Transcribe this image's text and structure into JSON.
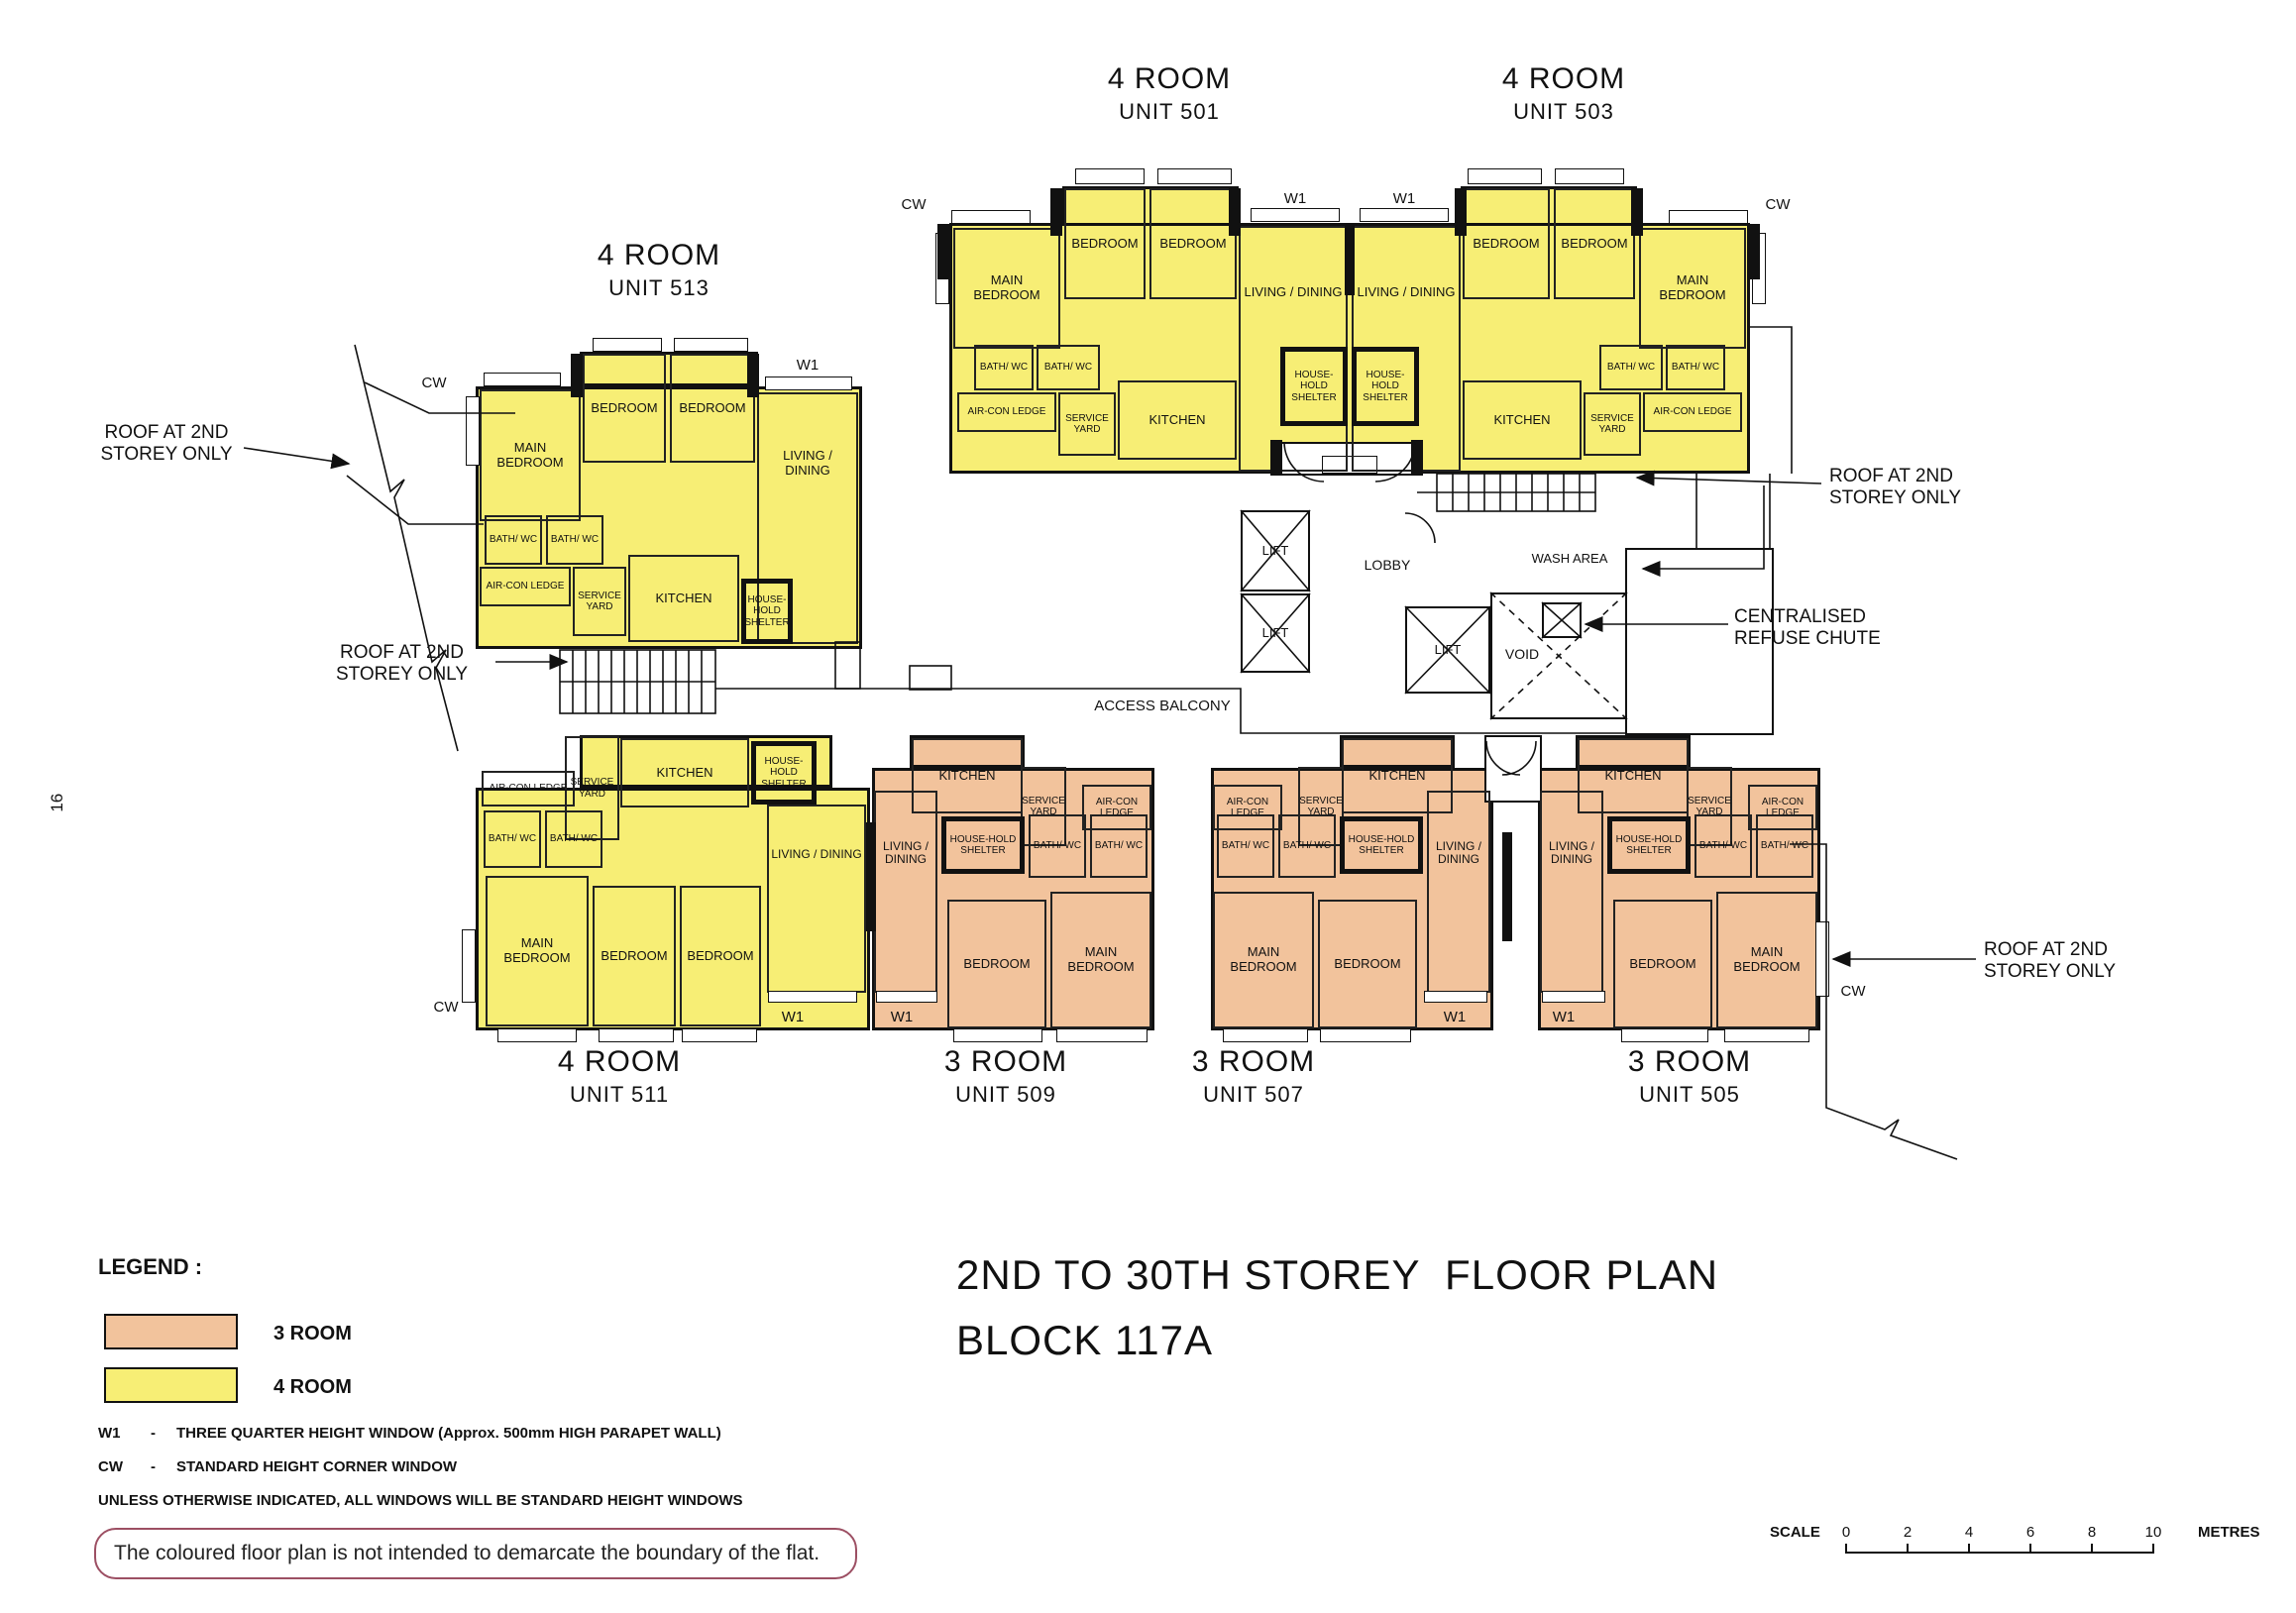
{
  "page_number": "16",
  "header": {
    "title_line1": "2ND TO 30TH STOREY  FLOOR PLAN",
    "title_line2": "BLOCK 117A"
  },
  "colors": {
    "three_room": "#f2c39c",
    "four_room": "#f7ee75"
  },
  "legend": {
    "heading": "LEGEND :",
    "items": [
      {
        "label": "3 ROOM",
        "color": "#f2c39c"
      },
      {
        "label": "4 ROOM",
        "color": "#f7ee75"
      }
    ],
    "window_notes": [
      {
        "code": "W1",
        "dash": "-",
        "text": "THREE QUARTER HEIGHT WINDOW (Approx. 500mm HIGH PARAPET WALL)"
      },
      {
        "code": "CW",
        "dash": "-",
        "text": "STANDARD HEIGHT CORNER WINDOW"
      }
    ],
    "footnote": "UNLESS OTHERWISE INDICATED, ALL WINDOWS WILL BE STANDARD HEIGHT WINDOWS"
  },
  "disclaimer": "The coloured floor plan is not intended to demarcate the boundary of the flat.",
  "scale_bar": {
    "label": "SCALE",
    "ticks": [
      "0",
      "2",
      "4",
      "6",
      "8",
      "10"
    ],
    "unit": "METRES"
  },
  "units": {
    "u501": {
      "type": "4 ROOM",
      "number": "UNIT 501"
    },
    "u503": {
      "type": "4 ROOM",
      "number": "UNIT 503"
    },
    "u513": {
      "type": "4 ROOM",
      "number": "UNIT 513"
    },
    "u511": {
      "type": "4 ROOM",
      "number": "UNIT 511"
    },
    "u509": {
      "type": "3 ROOM",
      "number": "UNIT 509"
    },
    "u507": {
      "type": "3 ROOM",
      "number": "UNIT 507"
    },
    "u505": {
      "type": "3 ROOM",
      "number": "UNIT 505"
    }
  },
  "room_labels": {
    "main_bedroom": "MAIN BEDROOM",
    "bedroom": "BEDROOM",
    "living_dining": "LIVING / DINING",
    "kitchen": "KITCHEN",
    "bath_wc": "BATH/ WC",
    "aircon_ledge": "AIR-CON LEDGE",
    "service_yard": "SERVICE YARD",
    "household_shelter": "HOUSE-HOLD SHELTER",
    "lift": "LIFT",
    "lobby": "LOBBY",
    "wash_area": "WASH AREA",
    "void": "VOID",
    "access_balcony": "ACCESS BALCONY"
  },
  "window_codes": {
    "w1": "W1",
    "cw": "CW"
  },
  "annotations": {
    "roof_2nd_storey": "ROOF AT 2ND STOREY ONLY",
    "refuse_chute": "CENTRALISED REFUSE CHUTE"
  }
}
